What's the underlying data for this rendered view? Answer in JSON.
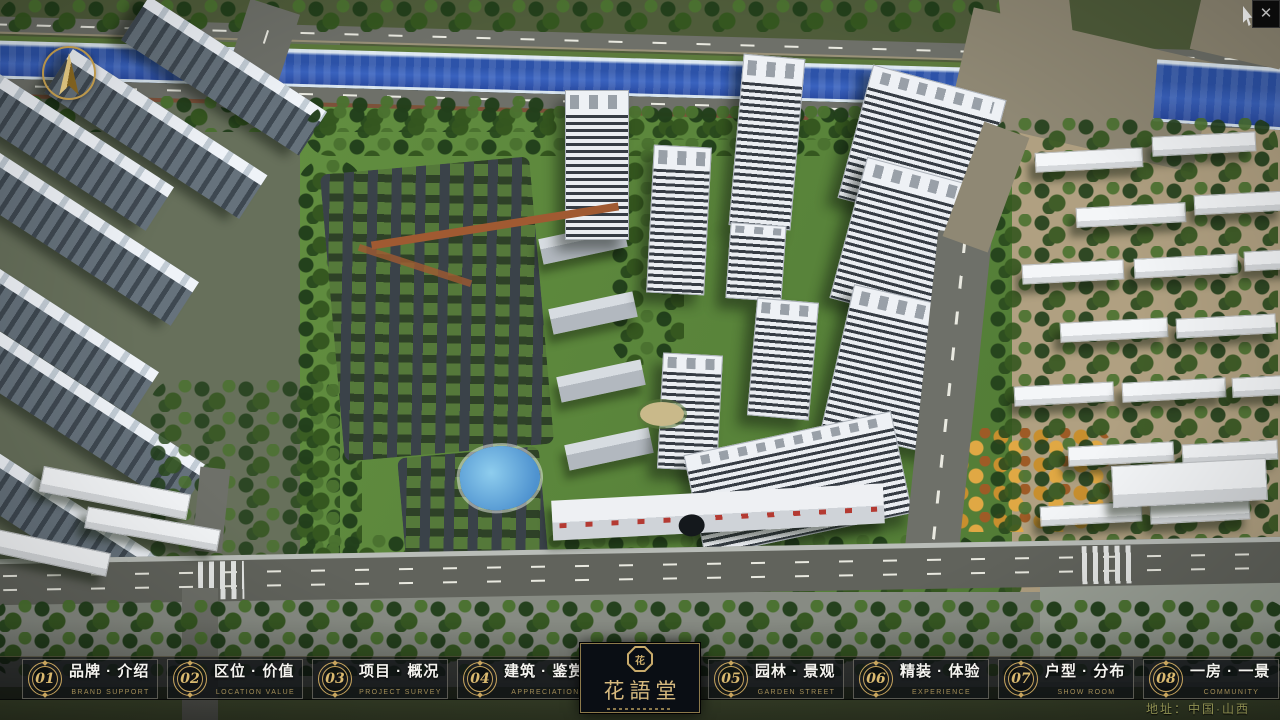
{
  "window": {
    "close": "✕"
  },
  "logo": {
    "title": "花語堂",
    "seal_char": "花"
  },
  "nav": {
    "items": [
      {
        "num": "01",
        "zh": "品牌 · 介绍",
        "en": "BRAND SUPPORT"
      },
      {
        "num": "02",
        "zh": "区位 · 价值",
        "en": "LOCATION VALUE"
      },
      {
        "num": "03",
        "zh": "项目 · 概况",
        "en": "PROJECT SURVEY"
      },
      {
        "num": "04",
        "zh": "建筑 · 鉴赏",
        "en": "APPRECIATION"
      },
      {
        "num": "05",
        "zh": "园林 · 景观",
        "en": "GARDEN STREET"
      },
      {
        "num": "06",
        "zh": "精装 · 体验",
        "en": "EXPERIENCE"
      },
      {
        "num": "07",
        "zh": "户型 · 分布",
        "en": "SHOW ROOM"
      },
      {
        "num": "08",
        "zh": "一房 · 一景",
        "en": "COMMUNITY"
      }
    ]
  },
  "footer": {
    "address": "地址：中国·山西"
  },
  "colors": {
    "gold": "#c9a96a",
    "panel": "#0a0e14",
    "river": "#2b4ea6"
  }
}
